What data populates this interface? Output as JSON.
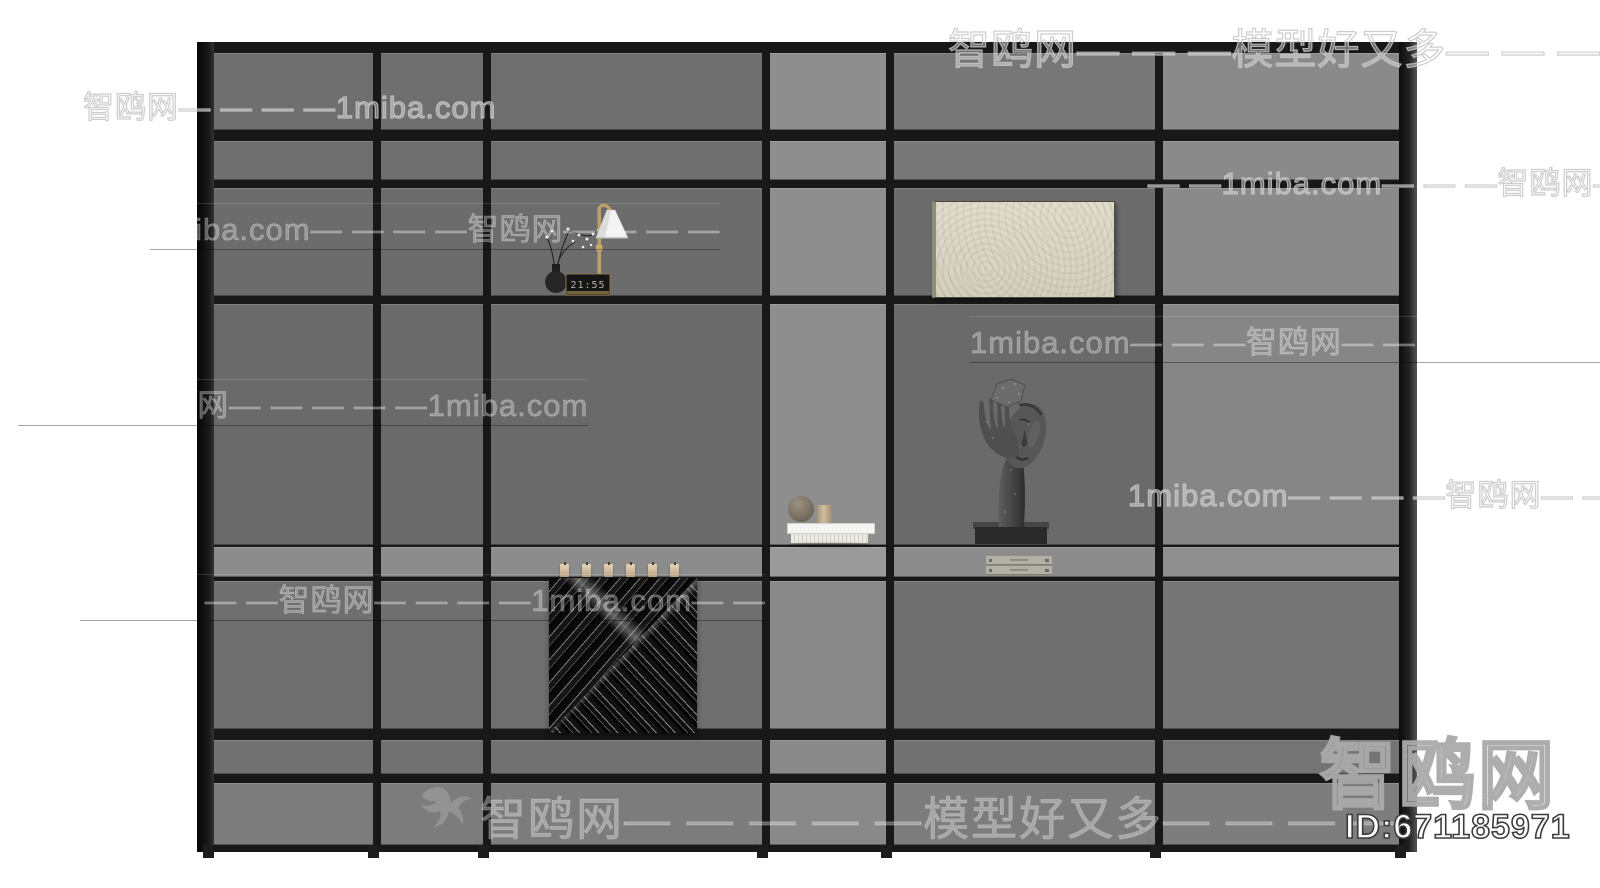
{
  "site": {
    "name": "智鸥网",
    "domain": "1miba.com",
    "tagline": "模型好又多"
  },
  "listing": {
    "logo_text": "智鸥网",
    "id_label": "ID:671185971"
  },
  "decor": {
    "clock_display": "21:55",
    "colors": {
      "panel_base": "#6d6d6d",
      "panel_light_column": "#8e8e8e",
      "panel_right_column": "#8a8a8a",
      "shelf_band": "#8c8c8c",
      "frame": "#181818",
      "art_cream": "#dad5c4",
      "lamp_brass": "#bfa06a",
      "candle": "#d9c5a4"
    }
  },
  "bottom_watermark": {
    "bird_icon": "seagull-icon",
    "text": "智鸥网— — — — —模型好又多— — — —"
  },
  "watermarks": [
    {
      "text": "智鸥网— — —模型好又多— — — —",
      "x": 948,
      "y": 16,
      "size": 42,
      "tone": "outline"
    },
    {
      "text": "智鸥网— — — —1miba.com",
      "x": 83,
      "y": 82,
      "size": 31,
      "tone": "outline"
    },
    {
      "text": "— —1miba.com— — —智鸥网— —",
      "x": 1148,
      "y": 158,
      "size": 31,
      "tone": "outline"
    },
    {
      "text": "1miba.com— — — —智鸥网— — — —",
      "x": 150,
      "y": 203,
      "size": 31,
      "tone": "panel"
    },
    {
      "text": "1miba.com— — —智鸥网— — —1miba.com— —",
      "x": 970,
      "y": 316,
      "size": 31,
      "tone": "panel"
    },
    {
      "text": "— — —智鸥网— — — — —1miba.com",
      "x": 18,
      "y": 379,
      "size": 31,
      "tone": "panel"
    },
    {
      "text": "1miba.com— — — —智鸥网— — — —",
      "x": 1128,
      "y": 470,
      "size": 31,
      "tone": "outline"
    },
    {
      "text": "— — — — —智鸥网— — — —1miba.com— —",
      "x": 80,
      "y": 574,
      "size": 31,
      "tone": "panel"
    }
  ]
}
